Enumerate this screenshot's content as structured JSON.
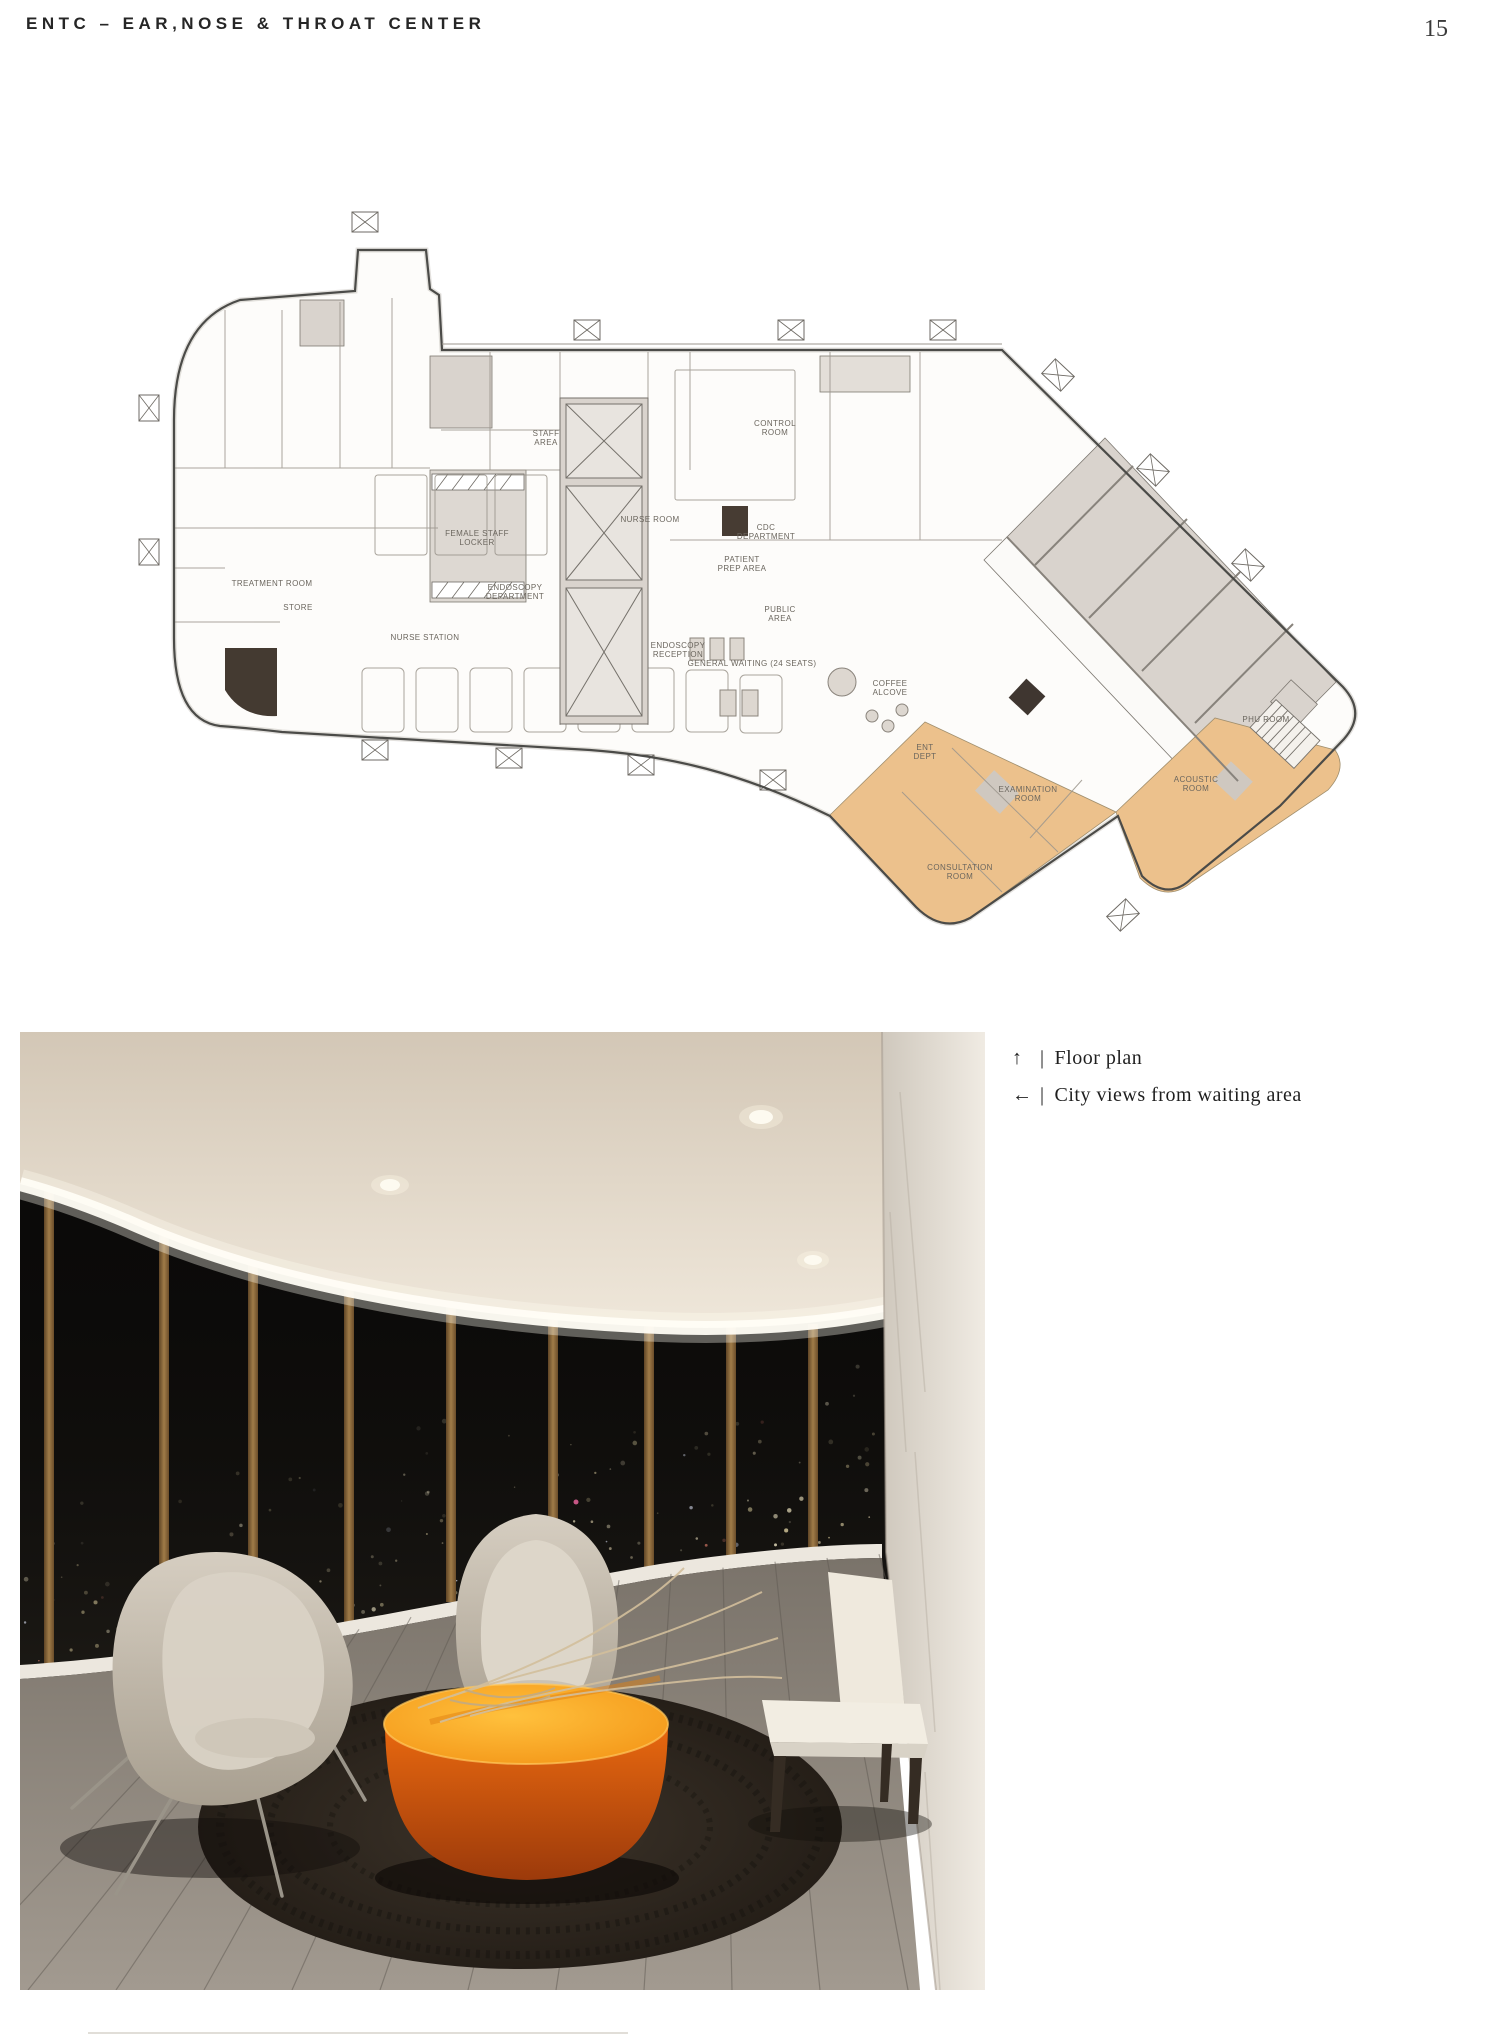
{
  "header": {
    "title": "ENTC – EAR,NOSE & THROAT CENTER",
    "page_number": "15"
  },
  "captions": [
    {
      "arrow": "↑",
      "separator": "|",
      "text": "Floor plan"
    },
    {
      "arrow": "←",
      "separator": "|",
      "text": "City views from waiting area"
    }
  ],
  "floor_plan": {
    "labels": [
      {
        "t": "ENDOSCOPY",
        "t2": "DEPARTMENT",
        "x": 385,
        "y": 420
      },
      {
        "t": "PUBLIC",
        "t2": "AREA",
        "x": 650,
        "y": 442
      },
      {
        "t": "CDC",
        "t2": "DEPARTMENT",
        "x": 636,
        "y": 360
      },
      {
        "t": "PATIENT",
        "t2": "PREP AREA",
        "x": 612,
        "y": 392
      },
      {
        "t": "ENT",
        "t2": "DEPT",
        "x": 795,
        "y": 580
      },
      {
        "t": "CONSULTATION",
        "t2": "ROOM",
        "x": 830,
        "y": 700
      },
      {
        "t": "EXAMINATION",
        "t2": "ROOM",
        "x": 898,
        "y": 622
      },
      {
        "t": "ACOUSTIC",
        "t2": "ROOM",
        "x": 1066,
        "y": 612
      },
      {
        "t": "PHU ROOM",
        "x": 1136,
        "y": 552
      },
      {
        "t": "FEMALE STAFF",
        "t2": "LOCKER",
        "x": 347,
        "y": 366
      },
      {
        "t": "STAFF",
        "t2": "AREA",
        "x": 416,
        "y": 266
      },
      {
        "t": "GENERAL WAITING (24 SEATS)",
        "x": 622,
        "y": 496
      },
      {
        "t": "ENDOSCOPY",
        "t2": "RECEPTION",
        "x": 548,
        "y": 478
      },
      {
        "t": "NURSE ROOM",
        "x": 520,
        "y": 352
      },
      {
        "t": "COFFEE",
        "t2": "ALCOVE",
        "x": 760,
        "y": 516
      },
      {
        "t": "CONTROL",
        "t2": "ROOM",
        "x": 645,
        "y": 256
      },
      {
        "t": "NURSE STATION",
        "x": 295,
        "y": 470
      },
      {
        "t": "STORE",
        "x": 168,
        "y": 440
      },
      {
        "t": "TREATMENT ROOM",
        "x": 142,
        "y": 416
      }
    ],
    "colors": {
      "paper": "#fdfcfa",
      "wall": "#4b4b48",
      "poche_gray": "#d9d3cd",
      "clinical_orange": "#ecc18c",
      "dark_room": "#443a31"
    }
  },
  "photo": {
    "colors": {
      "ceiling": "#e2d8ca",
      "mullion_bronze": "#8a6a3f",
      "window_glass": "#0b0a09",
      "sill_white": "#ece7de",
      "floor_gray": "#8d857c",
      "marble": "#e6e0d6",
      "rug_brown": "#2c251d",
      "table_top_orange": "#f59d1f",
      "table_side_orange": "#c8500f",
      "chair_cream": "#c7bfb1"
    }
  }
}
